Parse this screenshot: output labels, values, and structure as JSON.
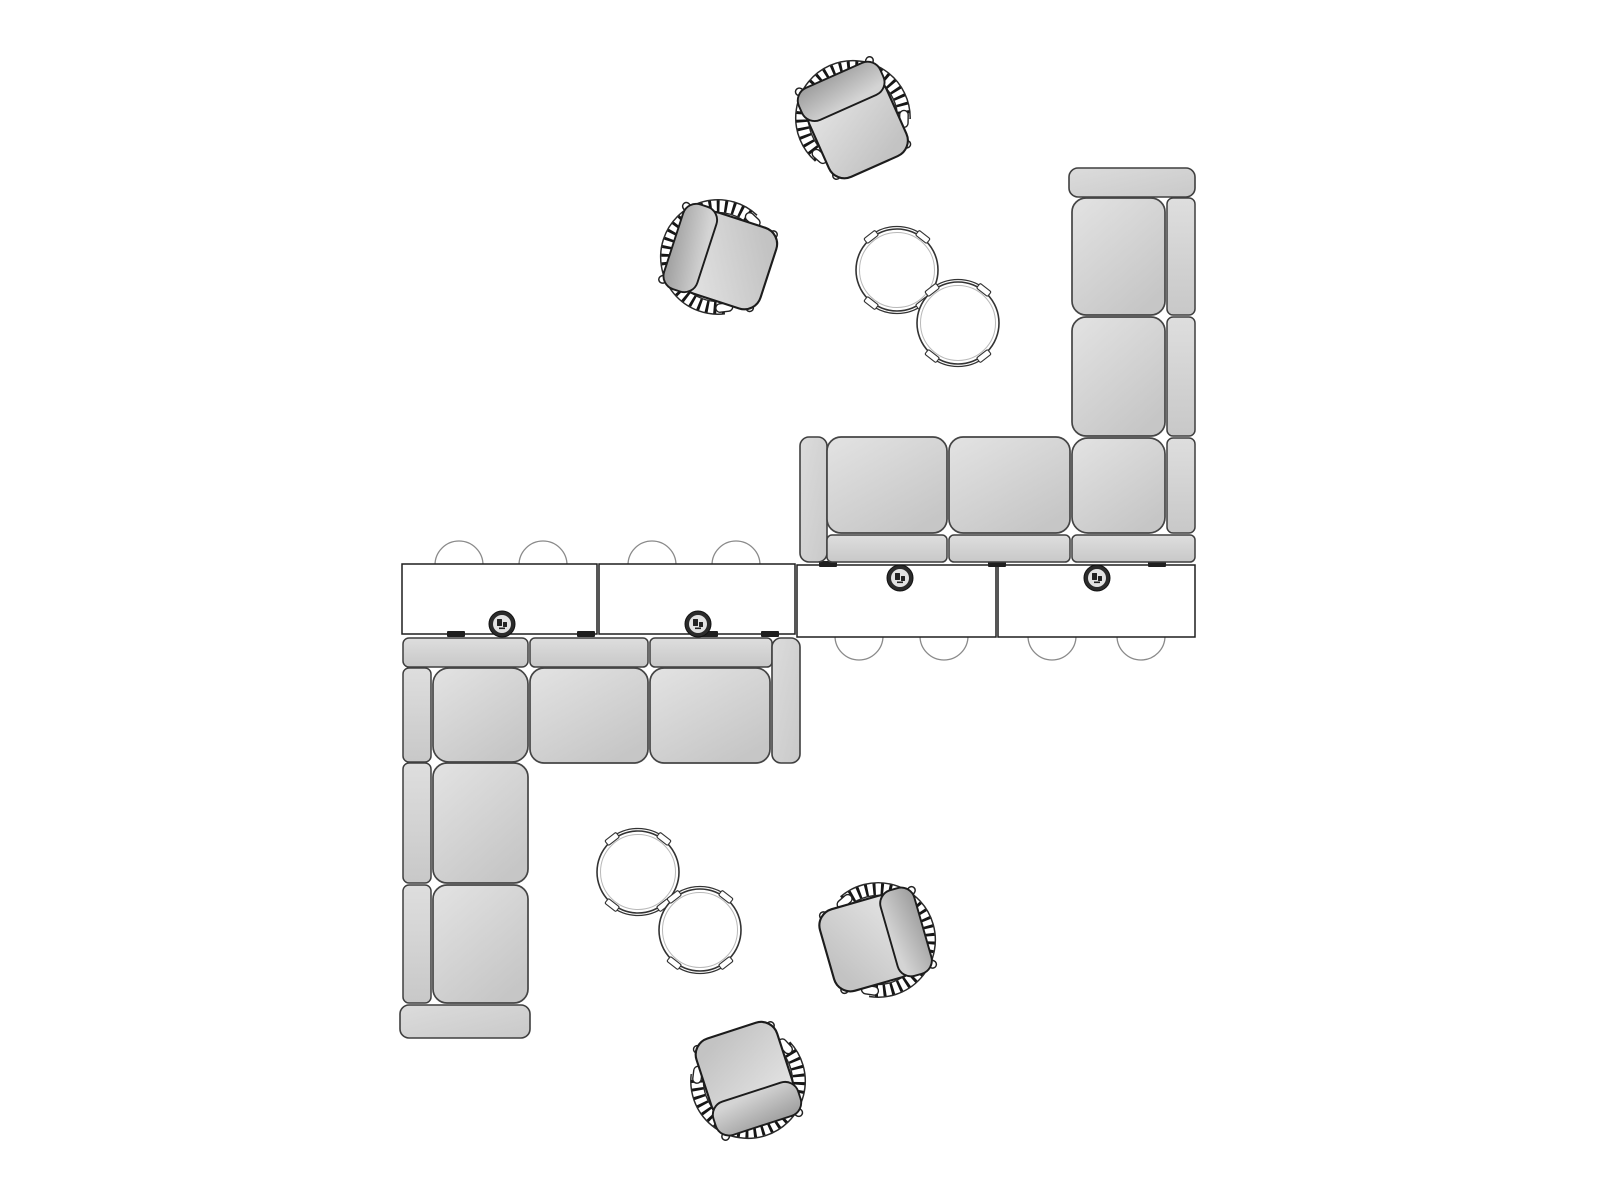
{
  "diagram": {
    "type": "furniture-plan-top-view",
    "description": "Top view planning drawing of two L-shaped sectional sofas back-to-back with rectangular tables, tuck-under stools, power grommets, paired round side tables and four woven lounge chairs",
    "canvas": {
      "width": 1600,
      "height": 1200,
      "background": "#ffffff"
    },
    "palette": {
      "cushion_light": "#e3e3e3",
      "cushion_dark": "#c6c6c6",
      "strip_light": "#dedede",
      "strip_dark": "#c8c8c8",
      "sofa_outline": "#454545",
      "table_fill": "#ffffff",
      "table_outline": "#1e1e1e",
      "stool_outline": "#8a8a8a",
      "clip_fill": "#1f1f1f",
      "grommet_ring": "#2b2b2b",
      "grommet_center": "#e3e3e3",
      "round_table_outline": "#333333",
      "round_table_inner": "#b8b8b8",
      "chair_weave": "#161616",
      "chair_outline": "#222222"
    },
    "dims": {
      "stool_r": 24,
      "grommet_r": 13,
      "round_table_r": 41,
      "chair_scale": 1.06
    },
    "sofa_segments": [
      {
        "sofa": "right",
        "kind": "arm",
        "x": 1069,
        "y": 168,
        "w": 126,
        "h": 29,
        "rx": 9
      },
      {
        "sofa": "right",
        "kind": "strip",
        "x": 1167,
        "y": 198,
        "w": 28,
        "h": 117,
        "rx": 6
      },
      {
        "sofa": "right",
        "kind": "strip",
        "x": 1167,
        "y": 317,
        "w": 28,
        "h": 119,
        "rx": 6
      },
      {
        "sofa": "right",
        "kind": "strip",
        "x": 1167,
        "y": 438,
        "w": 28,
        "h": 95,
        "rx": 6
      },
      {
        "sofa": "right",
        "kind": "cushion",
        "x": 1072,
        "y": 198,
        "w": 93,
        "h": 117,
        "rx": 14
      },
      {
        "sofa": "right",
        "kind": "cushion",
        "x": 1072,
        "y": 317,
        "w": 93,
        "h": 119,
        "rx": 14
      },
      {
        "sofa": "right",
        "kind": "cushion",
        "x": 1072,
        "y": 438,
        "w": 93,
        "h": 95,
        "rx": 16
      },
      {
        "sofa": "right",
        "kind": "arm",
        "x": 800,
        "y": 437,
        "w": 27,
        "h": 125,
        "rx": 9
      },
      {
        "sofa": "right",
        "kind": "cushion",
        "x": 827,
        "y": 437,
        "w": 120,
        "h": 96,
        "rx": 14
      },
      {
        "sofa": "right",
        "kind": "cushion",
        "x": 949,
        "y": 437,
        "w": 121,
        "h": 96,
        "rx": 14
      },
      {
        "sofa": "right",
        "kind": "strip",
        "x": 827,
        "y": 535,
        "w": 120,
        "h": 27,
        "rx": 5
      },
      {
        "sofa": "right",
        "kind": "strip",
        "x": 949,
        "y": 535,
        "w": 121,
        "h": 27,
        "rx": 5
      },
      {
        "sofa": "right",
        "kind": "strip",
        "x": 1072,
        "y": 535,
        "w": 123,
        "h": 27,
        "rx": 5
      },
      {
        "sofa": "left",
        "kind": "strip",
        "x": 403,
        "y": 638,
        "w": 125,
        "h": 29,
        "rx": 6
      },
      {
        "sofa": "left",
        "kind": "strip",
        "x": 530,
        "y": 638,
        "w": 118,
        "h": 29,
        "rx": 5
      },
      {
        "sofa": "left",
        "kind": "strip",
        "x": 650,
        "y": 638,
        "w": 122,
        "h": 29,
        "rx": 5
      },
      {
        "sofa": "left",
        "kind": "arm",
        "x": 772,
        "y": 638,
        "w": 28,
        "h": 125,
        "rx": 9
      },
      {
        "sofa": "left",
        "kind": "cushion",
        "x": 433,
        "y": 668,
        "w": 95,
        "h": 94,
        "rx": 16
      },
      {
        "sofa": "left",
        "kind": "cushion",
        "x": 530,
        "y": 668,
        "w": 118,
        "h": 95,
        "rx": 14
      },
      {
        "sofa": "left",
        "kind": "cushion",
        "x": 650,
        "y": 668,
        "w": 120,
        "h": 95,
        "rx": 14
      },
      {
        "sofa": "left",
        "kind": "strip",
        "x": 403,
        "y": 668,
        "w": 28,
        "h": 94,
        "rx": 6
      },
      {
        "sofa": "left",
        "kind": "strip",
        "x": 403,
        "y": 763,
        "w": 28,
        "h": 120,
        "rx": 6
      },
      {
        "sofa": "left",
        "kind": "strip",
        "x": 403,
        "y": 885,
        "w": 28,
        "h": 118,
        "rx": 6
      },
      {
        "sofa": "left",
        "kind": "cushion",
        "x": 433,
        "y": 763,
        "w": 95,
        "h": 120,
        "rx": 14
      },
      {
        "sofa": "left",
        "kind": "cushion",
        "x": 433,
        "y": 885,
        "w": 95,
        "h": 118,
        "rx": 14
      },
      {
        "sofa": "left",
        "kind": "arm",
        "x": 400,
        "y": 1005,
        "w": 130,
        "h": 33,
        "rx": 9
      }
    ],
    "tables": [
      {
        "x": 402,
        "y": 564,
        "w": 195,
        "h": 70
      },
      {
        "x": 599,
        "y": 564,
        "w": 196,
        "h": 70
      },
      {
        "x": 797,
        "y": 565,
        "w": 199,
        "h": 72
      },
      {
        "x": 998,
        "y": 565,
        "w": 197,
        "h": 72
      }
    ],
    "table_clips": [
      {
        "cx": 456,
        "y": 631
      },
      {
        "cx": 586,
        "y": 631
      },
      {
        "cx": 709,
        "y": 631
      },
      {
        "cx": 770,
        "y": 631
      },
      {
        "cx": 828,
        "y": 561
      },
      {
        "cx": 997,
        "y": 561
      },
      {
        "cx": 1157,
        "y": 561
      }
    ],
    "grommets": [
      {
        "cx": 502,
        "cy": 624
      },
      {
        "cx": 698,
        "cy": 624
      },
      {
        "cx": 900,
        "cy": 578
      },
      {
        "cx": 1097,
        "cy": 578
      }
    ],
    "stools": [
      {
        "cx": 459,
        "cy": 565
      },
      {
        "cx": 543,
        "cy": 565
      },
      {
        "cx": 652,
        "cy": 565
      },
      {
        "cx": 736,
        "cy": 565
      },
      {
        "cx": 859,
        "cy": 636
      },
      {
        "cx": 944,
        "cy": 636
      },
      {
        "cx": 1052,
        "cy": 636
      },
      {
        "cx": 1141,
        "cy": 636
      }
    ],
    "round_tables": [
      {
        "cx": 897,
        "cy": 270
      },
      {
        "cx": 958,
        "cy": 323
      },
      {
        "cx": 638,
        "cy": 872
      },
      {
        "cx": 700,
        "cy": 930
      }
    ],
    "chairs": [
      {
        "cx": 853,
        "cy": 118,
        "rotation": -24
      },
      {
        "cx": 718,
        "cy": 257,
        "rotation": -72
      },
      {
        "cx": 878,
        "cy": 940,
        "rotation": 74
      },
      {
        "cx": 748,
        "cy": 1081,
        "rotation": 162
      }
    ]
  }
}
